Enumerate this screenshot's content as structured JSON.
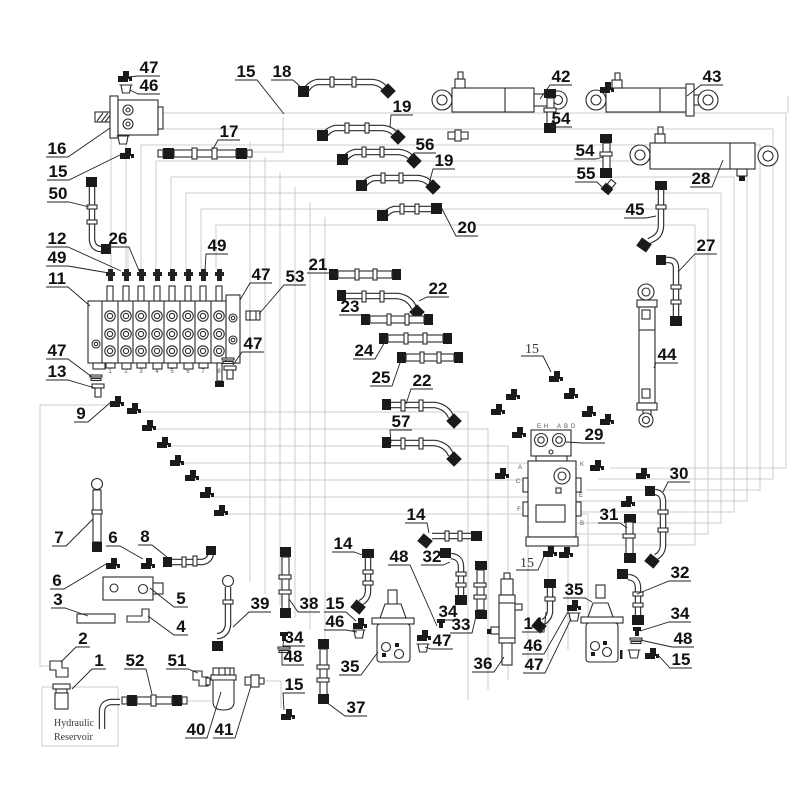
{
  "reservoir": {
    "line1": "Hydraulic",
    "line2": "Reservoir"
  },
  "colors": {
    "line": "#2b2b2b",
    "net": "#cccccc",
    "fitting_black": "#1a1a1a",
    "background": "#ffffff"
  },
  "callouts": [
    {
      "n": "47",
      "x": 149,
      "y": 67,
      "lx": 128,
      "ly": 77
    },
    {
      "n": "46",
      "x": 149,
      "y": 85,
      "lx": 130,
      "ly": 90
    },
    {
      "n": "16",
      "x": 57,
      "y": 148,
      "lx": 110,
      "ly": 128
    },
    {
      "n": "15",
      "x": 58,
      "y": 171,
      "lx": 124,
      "ly": 153
    },
    {
      "n": "17",
      "x": 229,
      "y": 131,
      "lx": 213,
      "ly": 149
    },
    {
      "n": "15",
      "x": 246,
      "y": 71,
      "lx": 284,
      "ly": 114
    },
    {
      "n": "18",
      "x": 282,
      "y": 71,
      "lx": 303,
      "ly": 89
    },
    {
      "n": "19",
      "x": 402,
      "y": 106,
      "lx": 390,
      "ly": 127
    },
    {
      "n": "56",
      "x": 425,
      "y": 144,
      "lx": 409,
      "ly": 158
    },
    {
      "n": "19",
      "x": 444,
      "y": 160,
      "lx": 429,
      "ly": 184
    },
    {
      "n": "20",
      "x": 467,
      "y": 227,
      "lx": 441,
      "ly": 207
    },
    {
      "n": "50",
      "x": 58,
      "y": 193,
      "lx": 89,
      "ly": 207
    },
    {
      "n": "12",
      "x": 57,
      "y": 238,
      "lx": 121,
      "ly": 271
    },
    {
      "n": "26",
      "x": 118,
      "y": 238,
      "lx": 140,
      "ly": 273
    },
    {
      "n": "49",
      "x": 57,
      "y": 257,
      "lx": 109,
      "ly": 273
    },
    {
      "n": "49",
      "x": 217,
      "y": 245,
      "lx": 205,
      "ly": 270
    },
    {
      "n": "11",
      "x": 57,
      "y": 278,
      "lx": 90,
      "ly": 306
    },
    {
      "n": "47",
      "x": 261,
      "y": 274,
      "lx": 240,
      "ly": 300
    },
    {
      "n": "53",
      "x": 295,
      "y": 276,
      "lx": 259,
      "ly": 314
    },
    {
      "n": "21",
      "x": 318,
      "y": 264,
      "lx": 334,
      "ly": 273
    },
    {
      "n": "22",
      "x": 438,
      "y": 288,
      "lx": 419,
      "ly": 301
    },
    {
      "n": "23",
      "x": 350,
      "y": 306,
      "lx": 367,
      "ly": 318
    },
    {
      "n": "24",
      "x": 364,
      "y": 350,
      "lx": 386,
      "ly": 340
    },
    {
      "n": "25",
      "x": 381,
      "y": 377,
      "lx": 401,
      "ly": 360
    },
    {
      "n": "22",
      "x": 422,
      "y": 380,
      "lx": 406,
      "ly": 404
    },
    {
      "n": "57",
      "x": 401,
      "y": 421,
      "lx": 391,
      "ly": 443
    },
    {
      "n": "47",
      "x": 57,
      "y": 350,
      "lx": 92,
      "ly": 377
    },
    {
      "n": "13",
      "x": 57,
      "y": 371,
      "lx": 95,
      "ly": 388
    },
    {
      "n": "9",
      "x": 81,
      "y": 413,
      "lx": 111,
      "ly": 402
    },
    {
      "n": "47",
      "x": 253,
      "y": 343,
      "lx": 233,
      "ly": 365
    },
    {
      "n": "42",
      "x": 561,
      "y": 76,
      "lx": 540,
      "ly": 99
    },
    {
      "n": "43",
      "x": 712,
      "y": 76,
      "lx": 687,
      "ly": 96
    },
    {
      "n": "54",
      "x": 561,
      "y": 118,
      "lx": 553,
      "ly": 120
    },
    {
      "n": "54",
      "x": 585,
      "y": 150,
      "lx": 603,
      "ly": 157
    },
    {
      "n": "55",
      "x": 586,
      "y": 173,
      "lx": 603,
      "ly": 188
    },
    {
      "n": "28",
      "x": 701,
      "y": 178,
      "lx": 723,
      "ly": 160
    },
    {
      "n": "45",
      "x": 635,
      "y": 209,
      "lx": 656,
      "ly": 216
    },
    {
      "n": "27",
      "x": 706,
      "y": 245,
      "lx": 678,
      "ly": 272
    },
    {
      "n": "44",
      "x": 667,
      "y": 354,
      "lx": 654,
      "ly": 368
    },
    {
      "n": "15",
      "x": 532,
      "y": 347,
      "lx": 551,
      "ly": 372,
      "s": "thin"
    },
    {
      "n": "30",
      "x": 679,
      "y": 473,
      "lx": 663,
      "ly": 492
    },
    {
      "n": "31",
      "x": 609,
      "y": 514,
      "lx": 627,
      "ly": 528
    },
    {
      "n": "32",
      "x": 680,
      "y": 572,
      "lx": 637,
      "ly": 594
    },
    {
      "n": "34",
      "x": 680,
      "y": 613,
      "lx": 640,
      "ly": 631
    },
    {
      "n": "48",
      "x": 683,
      "y": 638,
      "lx": 640,
      "ly": 640
    },
    {
      "n": "15",
      "x": 681,
      "y": 659,
      "lx": 657,
      "ly": 654
    },
    {
      "n": "29",
      "x": 594,
      "y": 434,
      "lx": 566,
      "ly": 442
    },
    {
      "n": "15",
      "x": 527,
      "y": 561,
      "lx": 546,
      "ly": 552,
      "s": "thin"
    },
    {
      "n": "14",
      "x": 416,
      "y": 514,
      "lx": 429,
      "ly": 533
    },
    {
      "n": "32",
      "x": 432,
      "y": 556,
      "lx": 450,
      "ly": 562
    },
    {
      "n": "48",
      "x": 399,
      "y": 556,
      "lx": 437,
      "ly": 626
    },
    {
      "n": "14",
      "x": 343,
      "y": 543,
      "lx": 365,
      "ly": 556
    },
    {
      "n": "39",
      "x": 260,
      "y": 603,
      "lx": 233,
      "ly": 627
    },
    {
      "n": "38",
      "x": 309,
      "y": 603,
      "lx": 289,
      "ly": 599
    },
    {
      "n": "15",
      "x": 335,
      "y": 603,
      "lx": 356,
      "ly": 621
    },
    {
      "n": "46",
      "x": 335,
      "y": 621,
      "lx": 357,
      "ly": 632
    },
    {
      "n": "34",
      "x": 294,
      "y": 637,
      "lx": 284,
      "ly": 636
    },
    {
      "n": "48",
      "x": 293,
      "y": 656,
      "lx": 282,
      "ly": 650
    },
    {
      "n": "35",
      "x": 350,
      "y": 666,
      "lx": 378,
      "ly": 652
    },
    {
      "n": "15",
      "x": 294,
      "y": 684,
      "lx": 284,
      "ly": 710
    },
    {
      "n": "37",
      "x": 356,
      "y": 707,
      "lx": 322,
      "ly": 699
    },
    {
      "n": "36",
      "x": 483,
      "y": 663,
      "lx": 504,
      "ly": 657
    },
    {
      "n": "34",
      "x": 448,
      "y": 611,
      "lx": 441,
      "ly": 622
    },
    {
      "n": "33",
      "x": 461,
      "y": 624,
      "lx": 477,
      "ly": 612
    },
    {
      "n": "47",
      "x": 442,
      "y": 640,
      "lx": 425,
      "ly": 647
    },
    {
      "n": "14",
      "x": 533,
      "y": 623,
      "lx": 546,
      "ly": 612
    },
    {
      "n": "46",
      "x": 533,
      "y": 645,
      "lx": 569,
      "ly": 610
    },
    {
      "n": "47",
      "x": 534,
      "y": 664,
      "lx": 571,
      "ly": 619
    },
    {
      "n": "35",
      "x": 574,
      "y": 589,
      "lx": 592,
      "ly": 602
    },
    {
      "n": "7",
      "x": 59,
      "y": 537,
      "lx": 93,
      "ly": 519
    },
    {
      "n": "6",
      "x": 113,
      "y": 537,
      "lx": 143,
      "ly": 559
    },
    {
      "n": "8",
      "x": 145,
      "y": 536,
      "lx": 167,
      "ly": 557
    },
    {
      "n": "6",
      "x": 57,
      "y": 580,
      "lx": 106,
      "ly": 564
    },
    {
      "n": "3",
      "x": 58,
      "y": 599,
      "lx": 88,
      "ly": 616
    },
    {
      "n": "5",
      "x": 181,
      "y": 598,
      "lx": 150,
      "ly": 588
    },
    {
      "n": "4",
      "x": 181,
      "y": 626,
      "lx": 148,
      "ly": 616
    },
    {
      "n": "2",
      "x": 83,
      "y": 638,
      "lx": 61,
      "ly": 662
    },
    {
      "n": "1",
      "x": 99,
      "y": 660,
      "lx": 72,
      "ly": 689
    },
    {
      "n": "52",
      "x": 135,
      "y": 660,
      "lx": 152,
      "ly": 694
    },
    {
      "n": "51",
      "x": 177,
      "y": 660,
      "lx": 198,
      "ly": 673
    },
    {
      "n": "40",
      "x": 196,
      "y": 729,
      "lx": 221,
      "ly": 692
    },
    {
      "n": "41",
      "x": 224,
      "y": 729,
      "lx": 251,
      "ly": 686
    }
  ],
  "tiny_labels": [
    {
      "t": "1",
      "x": 110,
      "y": 373
    },
    {
      "t": "2",
      "x": 126,
      "y": 373
    },
    {
      "t": "3",
      "x": 141,
      "y": 373
    },
    {
      "t": "4",
      "x": 157,
      "y": 373
    },
    {
      "t": "5",
      "x": 172,
      "y": 373
    },
    {
      "t": "6",
      "x": 188,
      "y": 373
    },
    {
      "t": "7",
      "x": 203,
      "y": 373
    },
    {
      "t": "8",
      "x": 219,
      "y": 373
    },
    {
      "t": "E",
      "x": 539,
      "y": 428
    },
    {
      "t": "H",
      "x": 546,
      "y": 428
    },
    {
      "t": "A",
      "x": 559,
      "y": 428
    },
    {
      "t": "B",
      "x": 566,
      "y": 428
    },
    {
      "t": "D",
      "x": 573,
      "y": 428
    },
    {
      "t": "A",
      "x": 520,
      "y": 469
    },
    {
      "t": "K",
      "x": 582,
      "y": 466
    },
    {
      "t": "C",
      "x": 518,
      "y": 483
    },
    {
      "t": "E",
      "x": 581,
      "y": 497
    },
    {
      "t": "F",
      "x": 519,
      "y": 511
    },
    {
      "t": "B",
      "x": 582,
      "y": 525
    }
  ]
}
